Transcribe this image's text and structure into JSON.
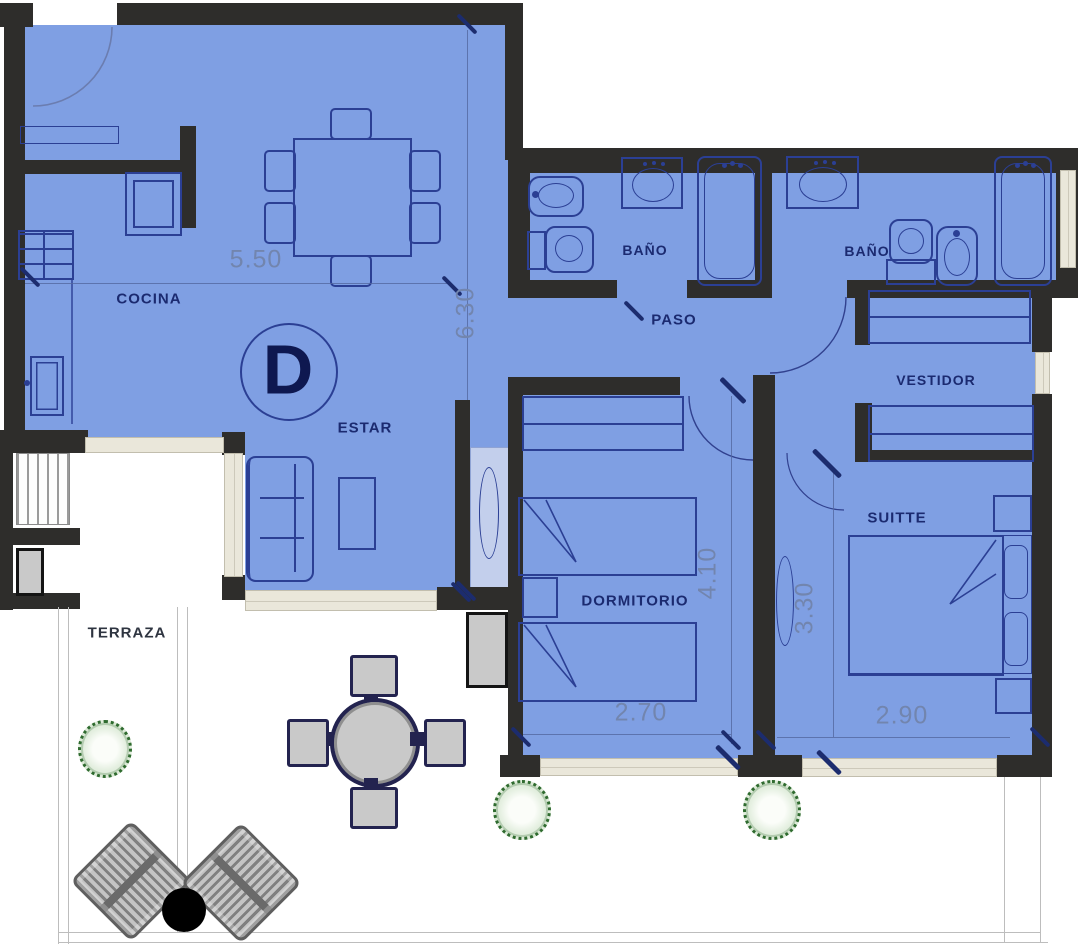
{
  "plan": {
    "unit_label": "D",
    "rooms": {
      "cocina": {
        "label": "COCINA"
      },
      "estar": {
        "label": "ESTAR"
      },
      "bano_1": {
        "label": "BAÑO"
      },
      "bano_2": {
        "label": "BAÑO"
      },
      "paso": {
        "label": "PASO"
      },
      "vestidor": {
        "label": "VESTIDOR"
      },
      "dormitorio": {
        "label": "DORMITORIO"
      },
      "suitte": {
        "label": "SUITTE"
      },
      "terraza": {
        "label": "TERRAZA"
      }
    },
    "dims": {
      "d550": "5.50",
      "d630": "6.30",
      "d410": "4.10",
      "d330": "3.30",
      "d270": "2.70",
      "d290": "2.90"
    },
    "colors": {
      "floor_fill": "#7f9fe3",
      "wall": "#2e2d2b",
      "furniture_outline": "#2b3f94",
      "label_text": "#1b2a70",
      "dimension_text": "#7285ae",
      "window": "#eae7da",
      "terrace_floor": "#ffffff",
      "plant_green": "#2f6b2f",
      "outdoor_gray": "#c9c9c9"
    },
    "furniture": [
      "entry-door",
      "stove",
      "oven",
      "kitchen-sink",
      "kitchen-counter",
      "dining-table",
      "dining-chairs",
      "sofa",
      "coffee-table",
      "bidet",
      "toilet",
      "washbasin",
      "bathtub",
      "wardrobe",
      "single-beds",
      "nightstands",
      "double-bed",
      "closets",
      "outdoor-round-table",
      "outdoor-chairs",
      "lounge-chairs",
      "side-table",
      "plants",
      "vent-grille"
    ]
  }
}
